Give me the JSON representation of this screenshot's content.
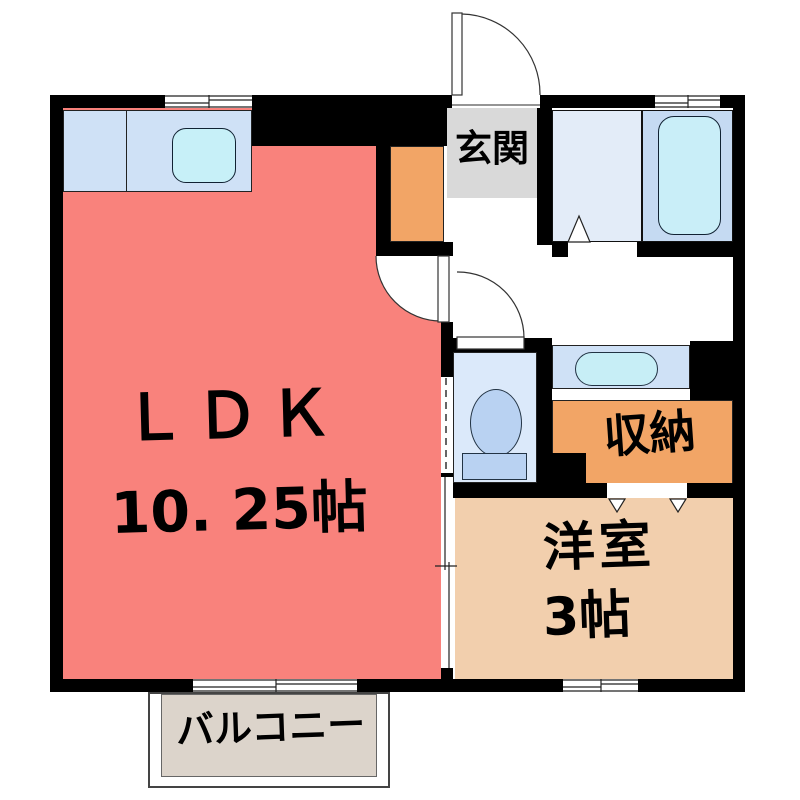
{
  "plan_title": "1K apartment floor plan",
  "rooms": [
    {
      "id": "ldk",
      "name": "ＬＤＫ",
      "size": "10. 25帖"
    },
    {
      "id": "entrance",
      "name": "玄関",
      "size": ""
    },
    {
      "id": "storage",
      "name": "収納",
      "size": ""
    },
    {
      "id": "western-room",
      "name": "洋室",
      "size": "3帖"
    },
    {
      "id": "balcony",
      "name": "バルコニー",
      "size": ""
    }
  ],
  "fixtures": [
    "kitchen-counter",
    "kitchen-sink",
    "washroom",
    "bathtub",
    "washbasin",
    "toilet",
    "entrance-door",
    "ldk-door",
    "toilet-door",
    "bathroom-door",
    "closet-doors",
    "sliding-door",
    "windows"
  ],
  "colors": {
    "wall": "#000000",
    "ldk_floor": "#f9827c",
    "entrance_floor": "#d9d9d9",
    "storage_floor": "#f2a566",
    "western_room_floor": "#f2cfad",
    "kitchen_counter": "#cfe1f6",
    "kitchen_sink": "#c7f0f8",
    "washroom_floor": "#e3ecf8",
    "bath_floor": "#c5daf2",
    "bathtub": "#c9eef8",
    "toilet_floor": "#dbe9fa",
    "toilet_fixture": "#b9d2f2",
    "washbasin_floor": "#cfe1f6",
    "washbasin_bowl": "#c7eef6",
    "balcony_floor": "#dcd4cb"
  }
}
